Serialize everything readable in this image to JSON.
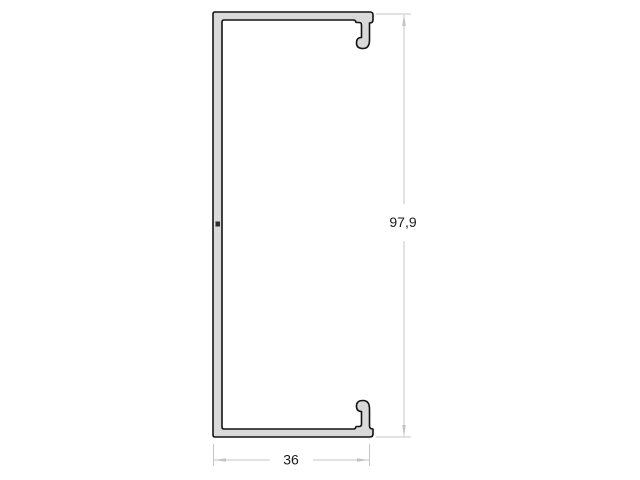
{
  "drawing": {
    "type": "technical-cross-section",
    "background_color": "#ffffff",
    "profile": {
      "name": "u-channel-profile",
      "fill_color": "#d9d9d9",
      "outline_color": "#141414"
    },
    "dimensions": {
      "line_color": "#c4c4c4",
      "text_color": "#1a1a1a",
      "height_label": "97,9",
      "width_label": "36"
    }
  }
}
